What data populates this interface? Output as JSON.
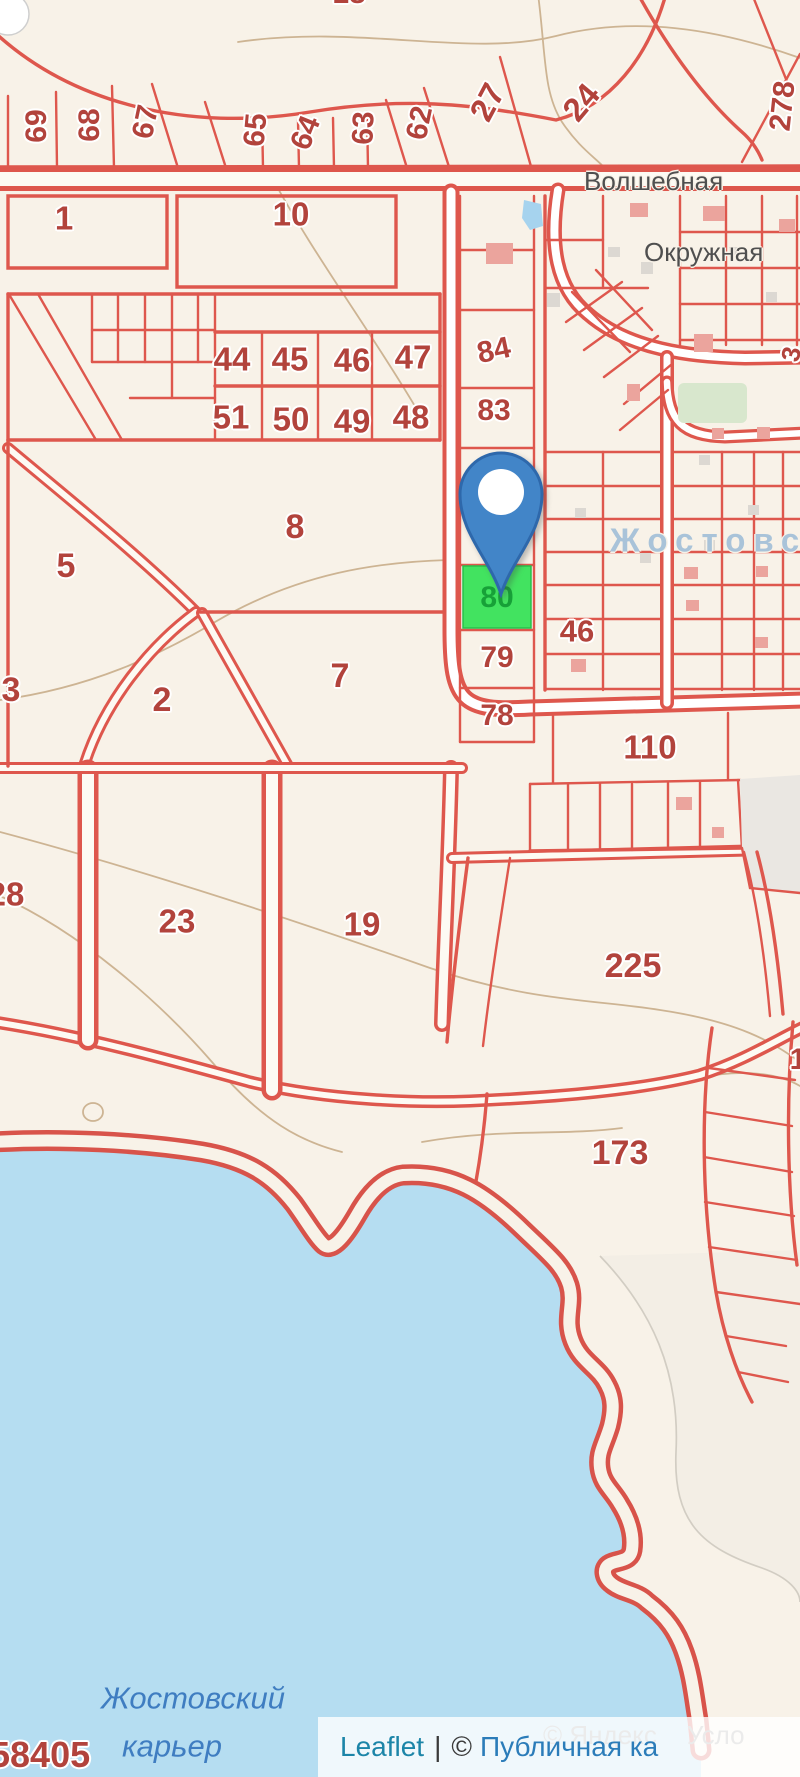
{
  "map": {
    "background_color": "#f8f2e8",
    "parcel_line_color": "#de574d",
    "parcel_label_color": "#b2433c",
    "water_color": "#b5ddf1",
    "selected_parcel": {
      "number": "80",
      "fill": "#42e360",
      "label_color": "#17a138"
    },
    "marker_color": "#4285c8"
  },
  "map_labels": {
    "items": [
      {
        "t": "69",
        "x": 37,
        "y": 126,
        "r": -90,
        "s": 30,
        "cls": "parcel"
      },
      {
        "t": "68",
        "x": 90,
        "y": 125,
        "r": -90,
        "s": 30,
        "cls": "parcel"
      },
      {
        "t": "67",
        "x": 146,
        "y": 122,
        "r": -78,
        "s": 30,
        "cls": "parcel"
      },
      {
        "t": "65",
        "x": 256,
        "y": 130,
        "r": -85,
        "s": 30,
        "cls": "parcel"
      },
      {
        "t": "64",
        "x": 306,
        "y": 133,
        "r": -68,
        "s": 30,
        "cls": "parcel"
      },
      {
        "t": "63",
        "x": 364,
        "y": 128,
        "r": -88,
        "s": 30,
        "cls": "parcel"
      },
      {
        "t": "62",
        "x": 420,
        "y": 123,
        "r": -78,
        "s": 30,
        "cls": "parcel"
      },
      {
        "t": "27",
        "x": 487,
        "y": 102,
        "r": -62,
        "s": 33,
        "cls": "parcel"
      },
      {
        "t": "24",
        "x": 581,
        "y": 102,
        "r": -50,
        "s": 33,
        "cls": "parcel"
      },
      {
        "t": "278",
        "x": 783,
        "y": 106,
        "r": -84,
        "s": 30,
        "cls": "parcel"
      },
      {
        "t": "18",
        "x": 349,
        "y": -6,
        "r": 0,
        "s": 30,
        "cls": "parcel"
      },
      {
        "t": "1",
        "x": 64,
        "y": 218,
        "r": 0,
        "s": 33,
        "cls": "parcel"
      },
      {
        "t": "10",
        "x": 291,
        "y": 214,
        "r": 0,
        "s": 33,
        "cls": "parcel"
      },
      {
        "t": "44",
        "x": 232,
        "y": 359,
        "r": 0,
        "s": 33,
        "cls": "parcel"
      },
      {
        "t": "45",
        "x": 290,
        "y": 359,
        "r": 0,
        "s": 33,
        "cls": "parcel"
      },
      {
        "t": "46",
        "x": 352,
        "y": 360,
        "r": 0,
        "s": 33,
        "cls": "parcel"
      },
      {
        "t": "47",
        "x": 413,
        "y": 357,
        "r": 0,
        "s": 33,
        "cls": "parcel"
      },
      {
        "t": "51",
        "x": 231,
        "y": 417,
        "r": 0,
        "s": 33,
        "cls": "parcel"
      },
      {
        "t": "50",
        "x": 291,
        "y": 419,
        "r": 0,
        "s": 33,
        "cls": "parcel"
      },
      {
        "t": "49",
        "x": 352,
        "y": 421,
        "r": 0,
        "s": 33,
        "cls": "parcel"
      },
      {
        "t": "48",
        "x": 411,
        "y": 417,
        "r": 0,
        "s": 33,
        "cls": "parcel"
      },
      {
        "t": "84",
        "x": 494,
        "y": 351,
        "r": -12,
        "s": 30,
        "cls": "parcel"
      },
      {
        "t": "83",
        "x": 494,
        "y": 411,
        "r": 0,
        "s": 30,
        "cls": "parcel"
      },
      {
        "t": "8",
        "x": 295,
        "y": 527,
        "r": 0,
        "s": 34,
        "cls": "parcel"
      },
      {
        "t": "5",
        "x": 66,
        "y": 566,
        "r": 0,
        "s": 34,
        "cls": "parcel"
      },
      {
        "t": "3",
        "x": 11,
        "y": 690,
        "r": 0,
        "s": 34,
        "cls": "parcel"
      },
      {
        "t": "2",
        "x": 162,
        "y": 700,
        "r": 0,
        "s": 34,
        "cls": "parcel"
      },
      {
        "t": "7",
        "x": 340,
        "y": 676,
        "r": 0,
        "s": 34,
        "cls": "parcel"
      },
      {
        "t": "80",
        "x": 497,
        "y": 598,
        "r": 0,
        "s": 30,
        "cls": "parcel-green"
      },
      {
        "t": "79",
        "x": 497,
        "y": 658,
        "r": 0,
        "s": 30,
        "cls": "parcel"
      },
      {
        "t": "78",
        "x": 497,
        "y": 716,
        "r": 0,
        "s": 30,
        "cls": "parcel"
      },
      {
        "t": "46",
        "x": 577,
        "y": 631,
        "r": 0,
        "s": 31,
        "cls": "parcel"
      },
      {
        "t": "110",
        "x": 650,
        "y": 747,
        "r": 0,
        "s": 33,
        "cls": "parcel"
      },
      {
        "t": "23",
        "x": 177,
        "y": 921,
        "r": 0,
        "s": 33,
        "cls": "parcel"
      },
      {
        "t": "19",
        "x": 362,
        "y": 924,
        "r": 0,
        "s": 33,
        "cls": "parcel"
      },
      {
        "t": "28",
        "x": 6,
        "y": 894,
        "r": 0,
        "s": 33,
        "cls": "parcel"
      },
      {
        "t": "225",
        "x": 633,
        "y": 966,
        "r": 0,
        "s": 34,
        "cls": "parcel"
      },
      {
        "t": "173",
        "x": 620,
        "y": 1153,
        "r": 0,
        "s": 34,
        "cls": "parcel"
      },
      {
        "t": "1",
        "x": 798,
        "y": 1060,
        "r": 0,
        "s": 30,
        "cls": "parcel"
      },
      {
        "t": "3",
        "x": 791,
        "y": 354,
        "r": -78,
        "s": 26,
        "cls": "parcel"
      },
      {
        "t": "58405",
        "x": -10,
        "y": 1755,
        "r": 0,
        "s": 36,
        "cls": "parcel",
        "a": "l"
      },
      {
        "t": "Волшебная",
        "x": 584,
        "y": 181,
        "r": 0,
        "s": 26,
        "cls": "street",
        "a": "l"
      },
      {
        "t": "Окружная",
        "x": 644,
        "y": 252,
        "r": 0,
        "s": 26,
        "cls": "street",
        "a": "l"
      },
      {
        "t": "Жостовск",
        "x": 610,
        "y": 540,
        "r": 0,
        "s": 33,
        "cls": "locality",
        "a": "l",
        "ls": 8
      },
      {
        "t": "Жостовский",
        "x": 193,
        "y": 1698,
        "r": 0,
        "s": 31,
        "cls": "water"
      },
      {
        "t": "карьер",
        "x": 172,
        "y": 1746,
        "r": 0,
        "s": 31,
        "cls": "water"
      }
    ]
  },
  "attribution": {
    "leaflet": "Leaflet",
    "separator": "|",
    "copyright_symbol": "©",
    "provider": "Публичная ка",
    "yandex": "© Яндекс",
    "yandex_terms": "Усло"
  }
}
